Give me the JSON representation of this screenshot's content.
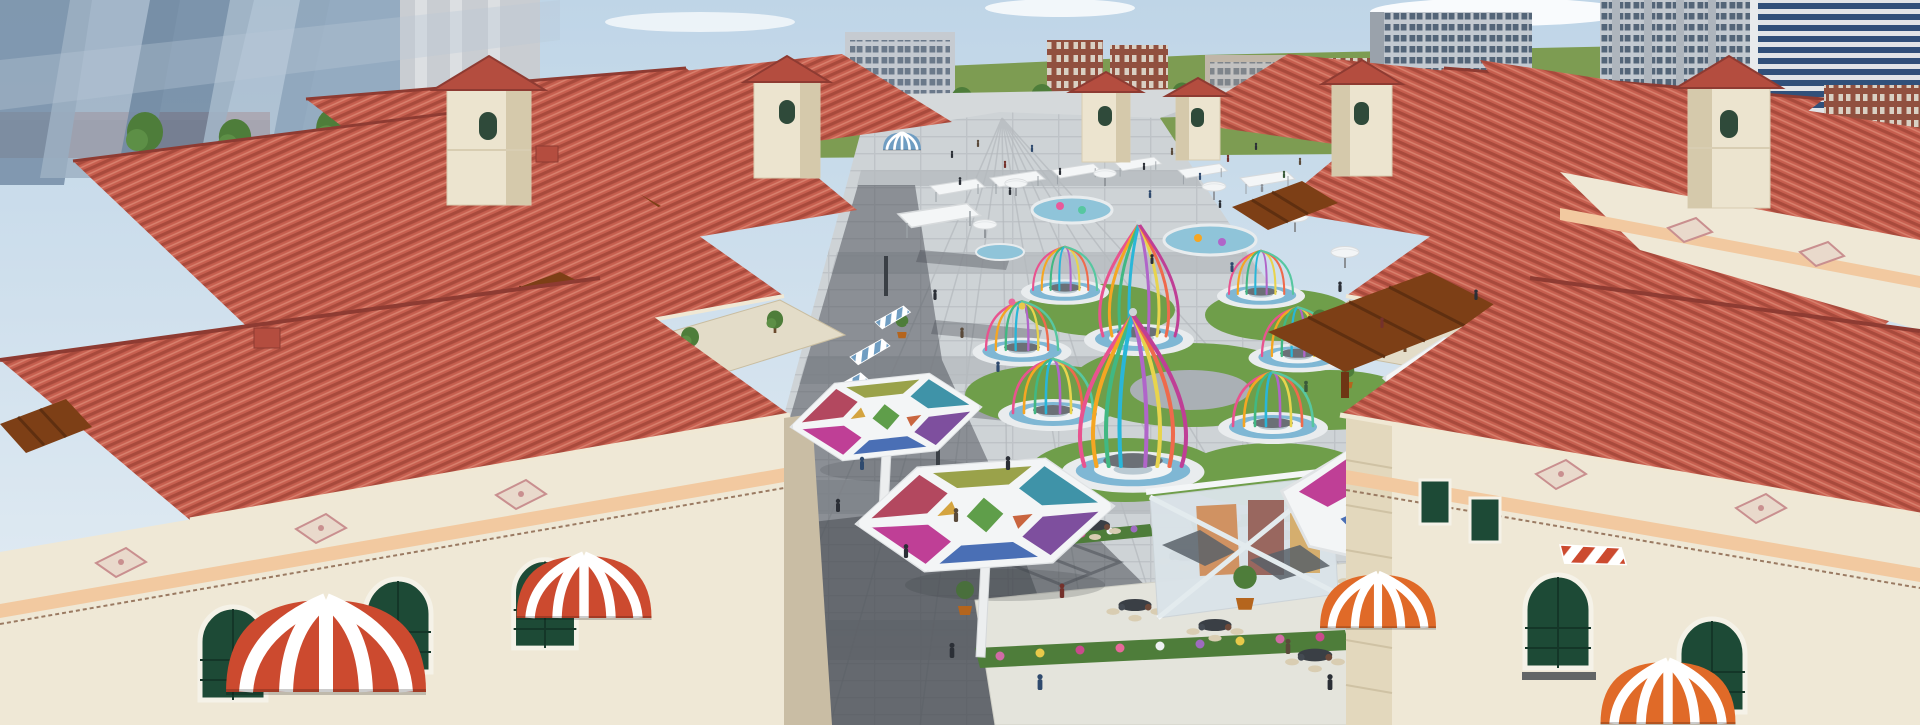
{
  "meta": {
    "type": "architectural_rendering",
    "title": "Aerial 3D rendering — Mediterranean-style open-air shopping street plaza",
    "description": "Bird's-eye rendering of a symmetrical outdoor retail street: terracotta tiled roofs, cream walls, wooden pergolas, striped awnings and dome canopies on both sides; central pedestrian plaza with colorful birdcage pavilions on round platforms, mosaic glass canopies over cafe seating, fountain pools, white parasols, market stalls and crowds; modern high-rise city blocks and green parkland on the horizon.",
    "canvas": {
      "width": 1920,
      "height": 725
    }
  },
  "colors": {
    "sky_top": "#bfd5e7",
    "sky_bottom": "#e7eff5",
    "cloud": "#ffffff",
    "grass": "#7d9c52",
    "glass_blue": "#8ca3ba",
    "concrete": "#c9cdd2",
    "apt_facade": "#c3c9d0",
    "apt_window": "#546578",
    "glass_band": "#31507a",
    "brick": "#91503f",
    "roof_base": "#c75f4f",
    "roof_dark": "#a84a3c",
    "roof_light": "#d9826f",
    "ridge": "#8e3b32",
    "eave": "#f0e8d4",
    "wall": "#efe8d6",
    "wall_shade": "#d5c9ad",
    "shop_wall": "#e3dcc8",
    "cornice": "#f2c9a0",
    "frieze_tile": "#e9d9cb",
    "frieze_accent": "#c98f8f",
    "window_green": "#1d4a36",
    "window_frame": "#f5f2e8",
    "pergola": "#7d3f16",
    "awning_blue": "#6f9dc2",
    "awning_red": "#cc4a2f",
    "awning_orange": "#e06a28",
    "awning_pink": "#c488a8",
    "awning_brown": "#8a6a4a",
    "paving_light": "#ced3d6",
    "paving_band": "#b5babe",
    "shadow": "#42464d",
    "lawn": "#6f9e4a",
    "water": "#8fc4d9",
    "platform_blue": "#7fb7d4",
    "cafe_floor": "#e4e4dc",
    "table": "#3a3f45",
    "chair": "#d9cdb2",
    "person": "#2b2f36"
  },
  "palette": {
    "cage_ribbons": [
      "#e8538f",
      "#f5a623",
      "#41b883",
      "#29b6d8",
      "#b065c9",
      "#e8d44d",
      "#ef6a4c",
      "#57c7a0",
      "#bf3f96"
    ],
    "canopy_panels": [
      "#b3485f",
      "#9aa24a",
      "#3f93a8",
      "#7e4f9e",
      "#4a6fb5",
      "#bf3f96",
      "#5f9e4a",
      "#d4a43f",
      "#c9653f"
    ],
    "flowers": [
      "#d16ba5",
      "#e8c94a",
      "#c94a8c",
      "#eef0f2",
      "#9e6bbf",
      "#e8699a"
    ]
  },
  "scene": {
    "background": {
      "left": "translucent blue glass high-rises with street trees",
      "center": "green parkland horizon with low apartment and brick blocks",
      "right": "gray apartment towers, dark glass tower, brick buildings"
    },
    "mall": {
      "style": "Mediterranean / Spanish colonial retail street",
      "roofs": "terracotta tile hipped roofs",
      "towers": 6,
      "pergolas": 5,
      "striped_dome_awnings": 4,
      "shop_awnings": 9,
      "decor": "pink floral frieze tiles, peach cornices, green-paned arched windows"
    },
    "plaza": {
      "birdcage_pavilions": 8,
      "mosaic_canopies": 3,
      "voronoi_canopy": 1,
      "fountain_pools": 3,
      "parasols": 8,
      "market_stalls": 9,
      "cafe_tables": 9,
      "flower_beds": 4,
      "glass_kiosk": 1,
      "people_approx": 60
    }
  }
}
